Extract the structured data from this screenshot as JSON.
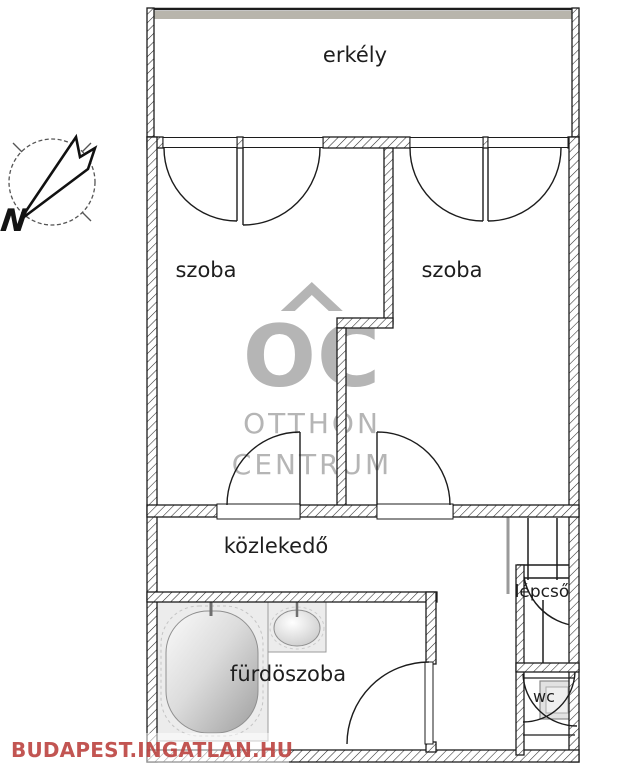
{
  "floorplan": {
    "labels": {
      "balcony": "erkély",
      "room_left": "szoba",
      "room_right": "szoba",
      "hallway": "közlekedő",
      "bathroom": "fürdöszoba",
      "stairs": "lépcső",
      "wc": "wc"
    },
    "compass": {
      "north_label": "N"
    }
  },
  "watermarks": {
    "center_logo": {
      "monogram": "OC",
      "line1": "OTTHON",
      "line2": "CENTRUM",
      "color": "#b5b5b5"
    },
    "footer": {
      "text": "BUDAPEST.INGATLAN.HU",
      "color": "#ba3e3a"
    }
  },
  "colors": {
    "wall_line": "#1c1c1c",
    "railing_gray": "#b8b5ac",
    "fixture_fill": "#ececec",
    "handrail_gray": "#9a9a9a"
  }
}
